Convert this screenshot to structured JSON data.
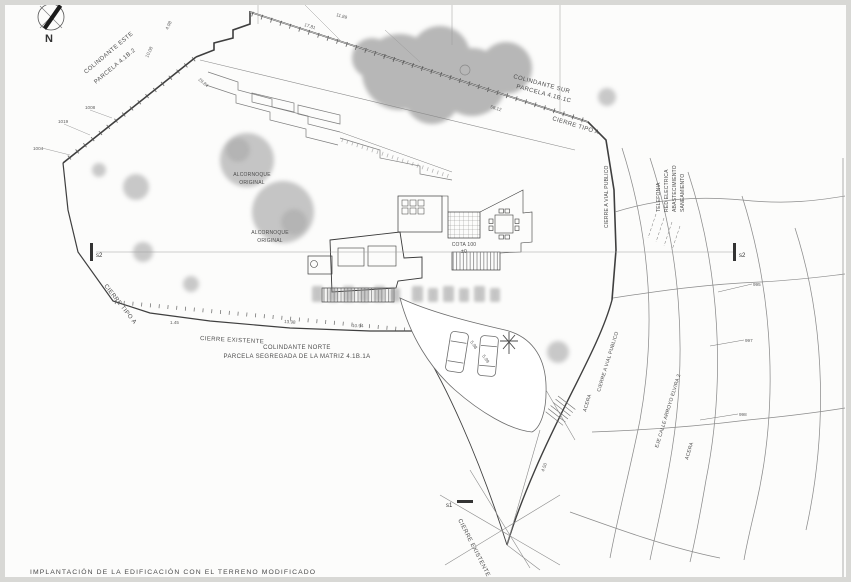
{
  "caption": "IMPLANTACIÓN DE LA EDIFICACIÓN CON EL TERRENO MODIFICADO",
  "compass": {
    "north_label": "N"
  },
  "adjacent_parcels": {
    "este_line1": "COLINDANTE ESTE",
    "este_line2": "PARCELA 4.1B.2",
    "sur_line1": "COLINDANTE SUR",
    "sur_line2": "PARCELA 4.1B.1C",
    "norte_line1": "COLINDANTE NORTE",
    "norte_line2": "PARCELA SEGREGADA DE LA MATRIZ 4.1B.1A"
  },
  "fences": {
    "tipo_a_top": "CIERRE TIPO A",
    "tipo_a_west": "CIERRE TIPO A",
    "existente_west": "CIERRE EXISTENTE",
    "existente_south": "CIERRE EXISTENTE",
    "vial_publico_upper": "CIERRE A VIAL PUBLICO",
    "vial_publico_lower": "CIERRE A VIAL PUBLICO"
  },
  "street": {
    "acera_upper": "ACERA",
    "acera_lower": "ACERA",
    "axis_label": "EJE CALLE ARROYO ELVIRA 2"
  },
  "utilities": {
    "telefonia": "TELEFONIA",
    "red_electrica": "RED ELECTRICA",
    "abastecimiento": "ABASTECIMIENTO",
    "saneamiento": "SANEAMIENTO"
  },
  "trees": {
    "alcornoque_1_line1": "ALCORNOQUE",
    "alcornoque_1_line2": "ORIGINAL",
    "alcornoque_2_line1": "ALCORNOQUE",
    "alcornoque_2_line2": "ORIGINAL"
  },
  "levels": {
    "cota": "COTA 100",
    "cota_ref": "±0",
    "contour_1": "995",
    "contour_2": "997",
    "contour_3": "998",
    "stake_1": "1004",
    "stake_2": "1019",
    "stake_3": "1008"
  },
  "sections": {
    "s2_left": "s2",
    "s2_right": "s2",
    "s1": "s1"
  },
  "dimensions": {
    "d1": "11.89",
    "d2": "17.81",
    "d3": "58.12",
    "d4": "29.84",
    "d5": "4.98",
    "d6": "10.08",
    "d7": "1.45",
    "d8": "13.98",
    "d9": "10.94",
    "d10": "5.98",
    "d11": "5.99",
    "d12": "4.50"
  }
}
